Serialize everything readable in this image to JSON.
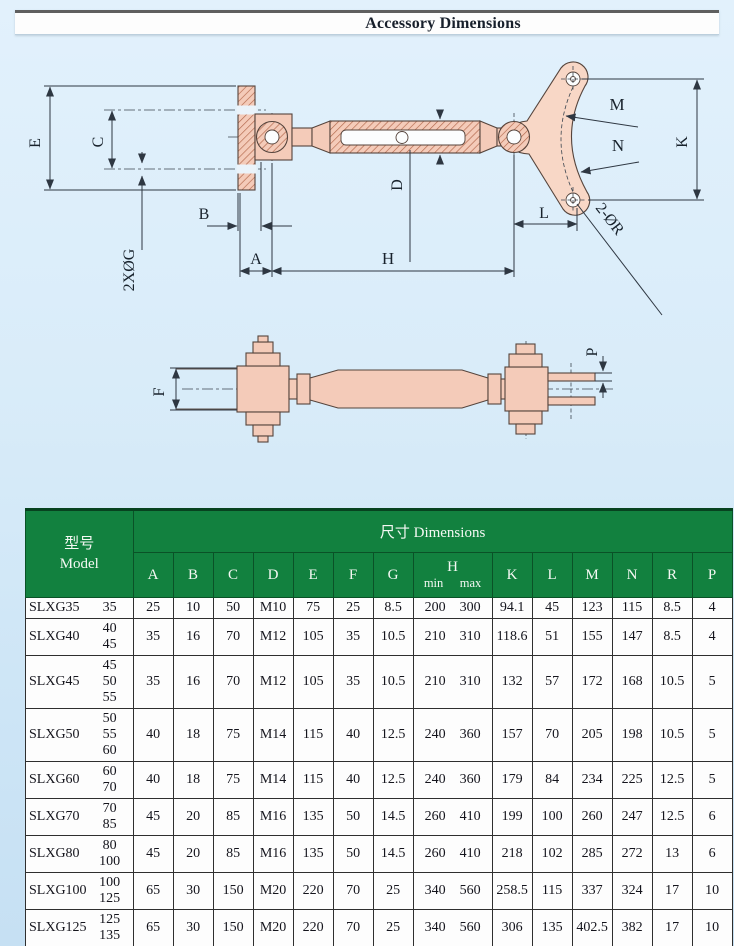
{
  "page": {
    "title": "Accessory Dimensions"
  },
  "drawing": {
    "front_labels": {
      "E": "E",
      "C": "C",
      "G": "2XØG",
      "B": "B",
      "A": "A",
      "H": "H",
      "D": "D",
      "L": "L",
      "K": "K",
      "M": "M",
      "N": "N",
      "R": "2-ØR"
    },
    "side_labels": {
      "F": "F",
      "P": "P"
    },
    "colors": {
      "part_fill": "#f4cbb9",
      "part_fill_light": "#f8d7c6",
      "hatch": "#b2664a",
      "outline": "#55443c"
    }
  },
  "table": {
    "model_header": {
      "cn": "型号",
      "en": "Model"
    },
    "dims_header": {
      "cn": "尺寸",
      "en": "Dimensions"
    },
    "columns": [
      "A",
      "B",
      "C",
      "D",
      "E",
      "F",
      "G",
      "H",
      "K",
      "L",
      "M",
      "N",
      "R",
      "P"
    ],
    "h_subcolumns": [
      "min",
      "max"
    ],
    "colors": {
      "header_bg": "#12813f",
      "header_text": "#f4f8f3",
      "body_bg": "#fdfdfd"
    },
    "rows": [
      {
        "model": "SLXG35",
        "sizes": [
          "35"
        ],
        "values": {
          "A": "25",
          "B": "10",
          "C": "50",
          "D": "M10",
          "E": "75",
          "F": "25",
          "G": "8.5",
          "H_min": "200",
          "H_max": "300",
          "K": "94.1",
          "L": "45",
          "M": "123",
          "N": "115",
          "R": "8.5",
          "P": "4"
        }
      },
      {
        "model": "SLXG40",
        "sizes": [
          "40",
          "45"
        ],
        "values": {
          "A": "35",
          "B": "16",
          "C": "70",
          "D": "M12",
          "E": "105",
          "F": "35",
          "G": "10.5",
          "H_min": "210",
          "H_max": "310",
          "K": "118.6",
          "L": "51",
          "M": "155",
          "N": "147",
          "R": "8.5",
          "P": "4"
        }
      },
      {
        "model": "SLXG45",
        "sizes": [
          "45",
          "50",
          "55"
        ],
        "values": {
          "A": "35",
          "B": "16",
          "C": "70",
          "D": "M12",
          "E": "105",
          "F": "35",
          "G": "10.5",
          "H_min": "210",
          "H_max": "310",
          "K": "132",
          "L": "57",
          "M": "172",
          "N": "168",
          "R": "10.5",
          "P": "5"
        }
      },
      {
        "model": "SLXG50",
        "sizes": [
          "50",
          "55",
          "60"
        ],
        "values": {
          "A": "40",
          "B": "18",
          "C": "75",
          "D": "M14",
          "E": "115",
          "F": "40",
          "G": "12.5",
          "H_min": "240",
          "H_max": "360",
          "K": "157",
          "L": "70",
          "M": "205",
          "N": "198",
          "R": "10.5",
          "P": "5"
        }
      },
      {
        "model": "SLXG60",
        "sizes": [
          "60",
          "70"
        ],
        "values": {
          "A": "40",
          "B": "18",
          "C": "75",
          "D": "M14",
          "E": "115",
          "F": "40",
          "G": "12.5",
          "H_min": "240",
          "H_max": "360",
          "K": "179",
          "L": "84",
          "M": "234",
          "N": "225",
          "R": "12.5",
          "P": "5"
        }
      },
      {
        "model": "SLXG70",
        "sizes": [
          "70",
          "85"
        ],
        "values": {
          "A": "45",
          "B": "20",
          "C": "85",
          "D": "M16",
          "E": "135",
          "F": "50",
          "G": "14.5",
          "H_min": "260",
          "H_max": "410",
          "K": "199",
          "L": "100",
          "M": "260",
          "N": "247",
          "R": "12.5",
          "P": "6"
        }
      },
      {
        "model": "SLXG80",
        "sizes": [
          "80",
          "100"
        ],
        "values": {
          "A": "45",
          "B": "20",
          "C": "85",
          "D": "M16",
          "E": "135",
          "F": "50",
          "G": "14.5",
          "H_min": "260",
          "H_max": "410",
          "K": "218",
          "L": "102",
          "M": "285",
          "N": "272",
          "R": "13",
          "P": "6"
        }
      },
      {
        "model": "SLXG100",
        "sizes": [
          "100",
          "125"
        ],
        "values": {
          "A": "65",
          "B": "30",
          "C": "150",
          "D": "M20",
          "E": "220",
          "F": "70",
          "G": "25",
          "H_min": "340",
          "H_max": "560",
          "K": "258.5",
          "L": "115",
          "M": "337",
          "N": "324",
          "R": "17",
          "P": "10"
        }
      },
      {
        "model": "SLXG125",
        "sizes": [
          "125",
          "135"
        ],
        "values": {
          "A": "65",
          "B": "30",
          "C": "150",
          "D": "M20",
          "E": "220",
          "F": "70",
          "G": "25",
          "H_min": "340",
          "H_max": "560",
          "K": "306",
          "L": "135",
          "M": "402.5",
          "N": "382",
          "R": "17",
          "P": "10"
        }
      }
    ]
  }
}
